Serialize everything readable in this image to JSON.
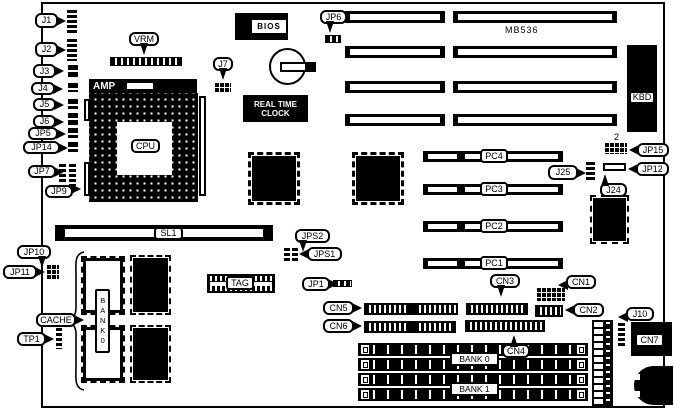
{
  "diagram": {
    "type": "motherboard-layout-diagram",
    "colors": {
      "ink": "#000000",
      "paper": "#ffffff"
    },
    "chip_labels": {
      "bios": "BIOS",
      "rtc_line1": "REAL TIME",
      "rtc_line2": "CLOCK",
      "amp": "AMP",
      "cpu": "CPU",
      "kbd": "KBD",
      "model": "MB536",
      "tag": "TAG",
      "cache_bank": "BANK0",
      "sl1": "SL1",
      "pin2": "2"
    },
    "callouts": {
      "j1": "J1",
      "j2": "J2",
      "j3": "J3",
      "j4": "J4",
      "j5": "J5",
      "j6": "J6",
      "jp5": "JP5",
      "jp14": "JP14",
      "jp7": "JP7",
      "jp9": "JP9",
      "jp10": "JP10",
      "jp11": "JP11",
      "cache": "CACHE",
      "tp1": "TP1",
      "vrm": "VRM",
      "j7": "J7",
      "jp6": "JP6",
      "jps2": "JPS2",
      "jps1": "JPS1",
      "jp1": "JP1",
      "cn5": "CN5",
      "cn6": "CN6",
      "cn3": "CN3",
      "cn4": "CN4",
      "cn1": "CN1",
      "cn2": "CN2",
      "j25": "J25",
      "jp12": "JP12",
      "j24": "J24",
      "jp15": "JP15",
      "j10": "J10",
      "cn7": "CN7"
    },
    "slots": {
      "pci": [
        "PC4",
        "PC3",
        "PC2",
        "PC1"
      ],
      "isa_count": 4,
      "simm_banks": [
        "BANK 0",
        "BANK 1"
      ]
    }
  }
}
